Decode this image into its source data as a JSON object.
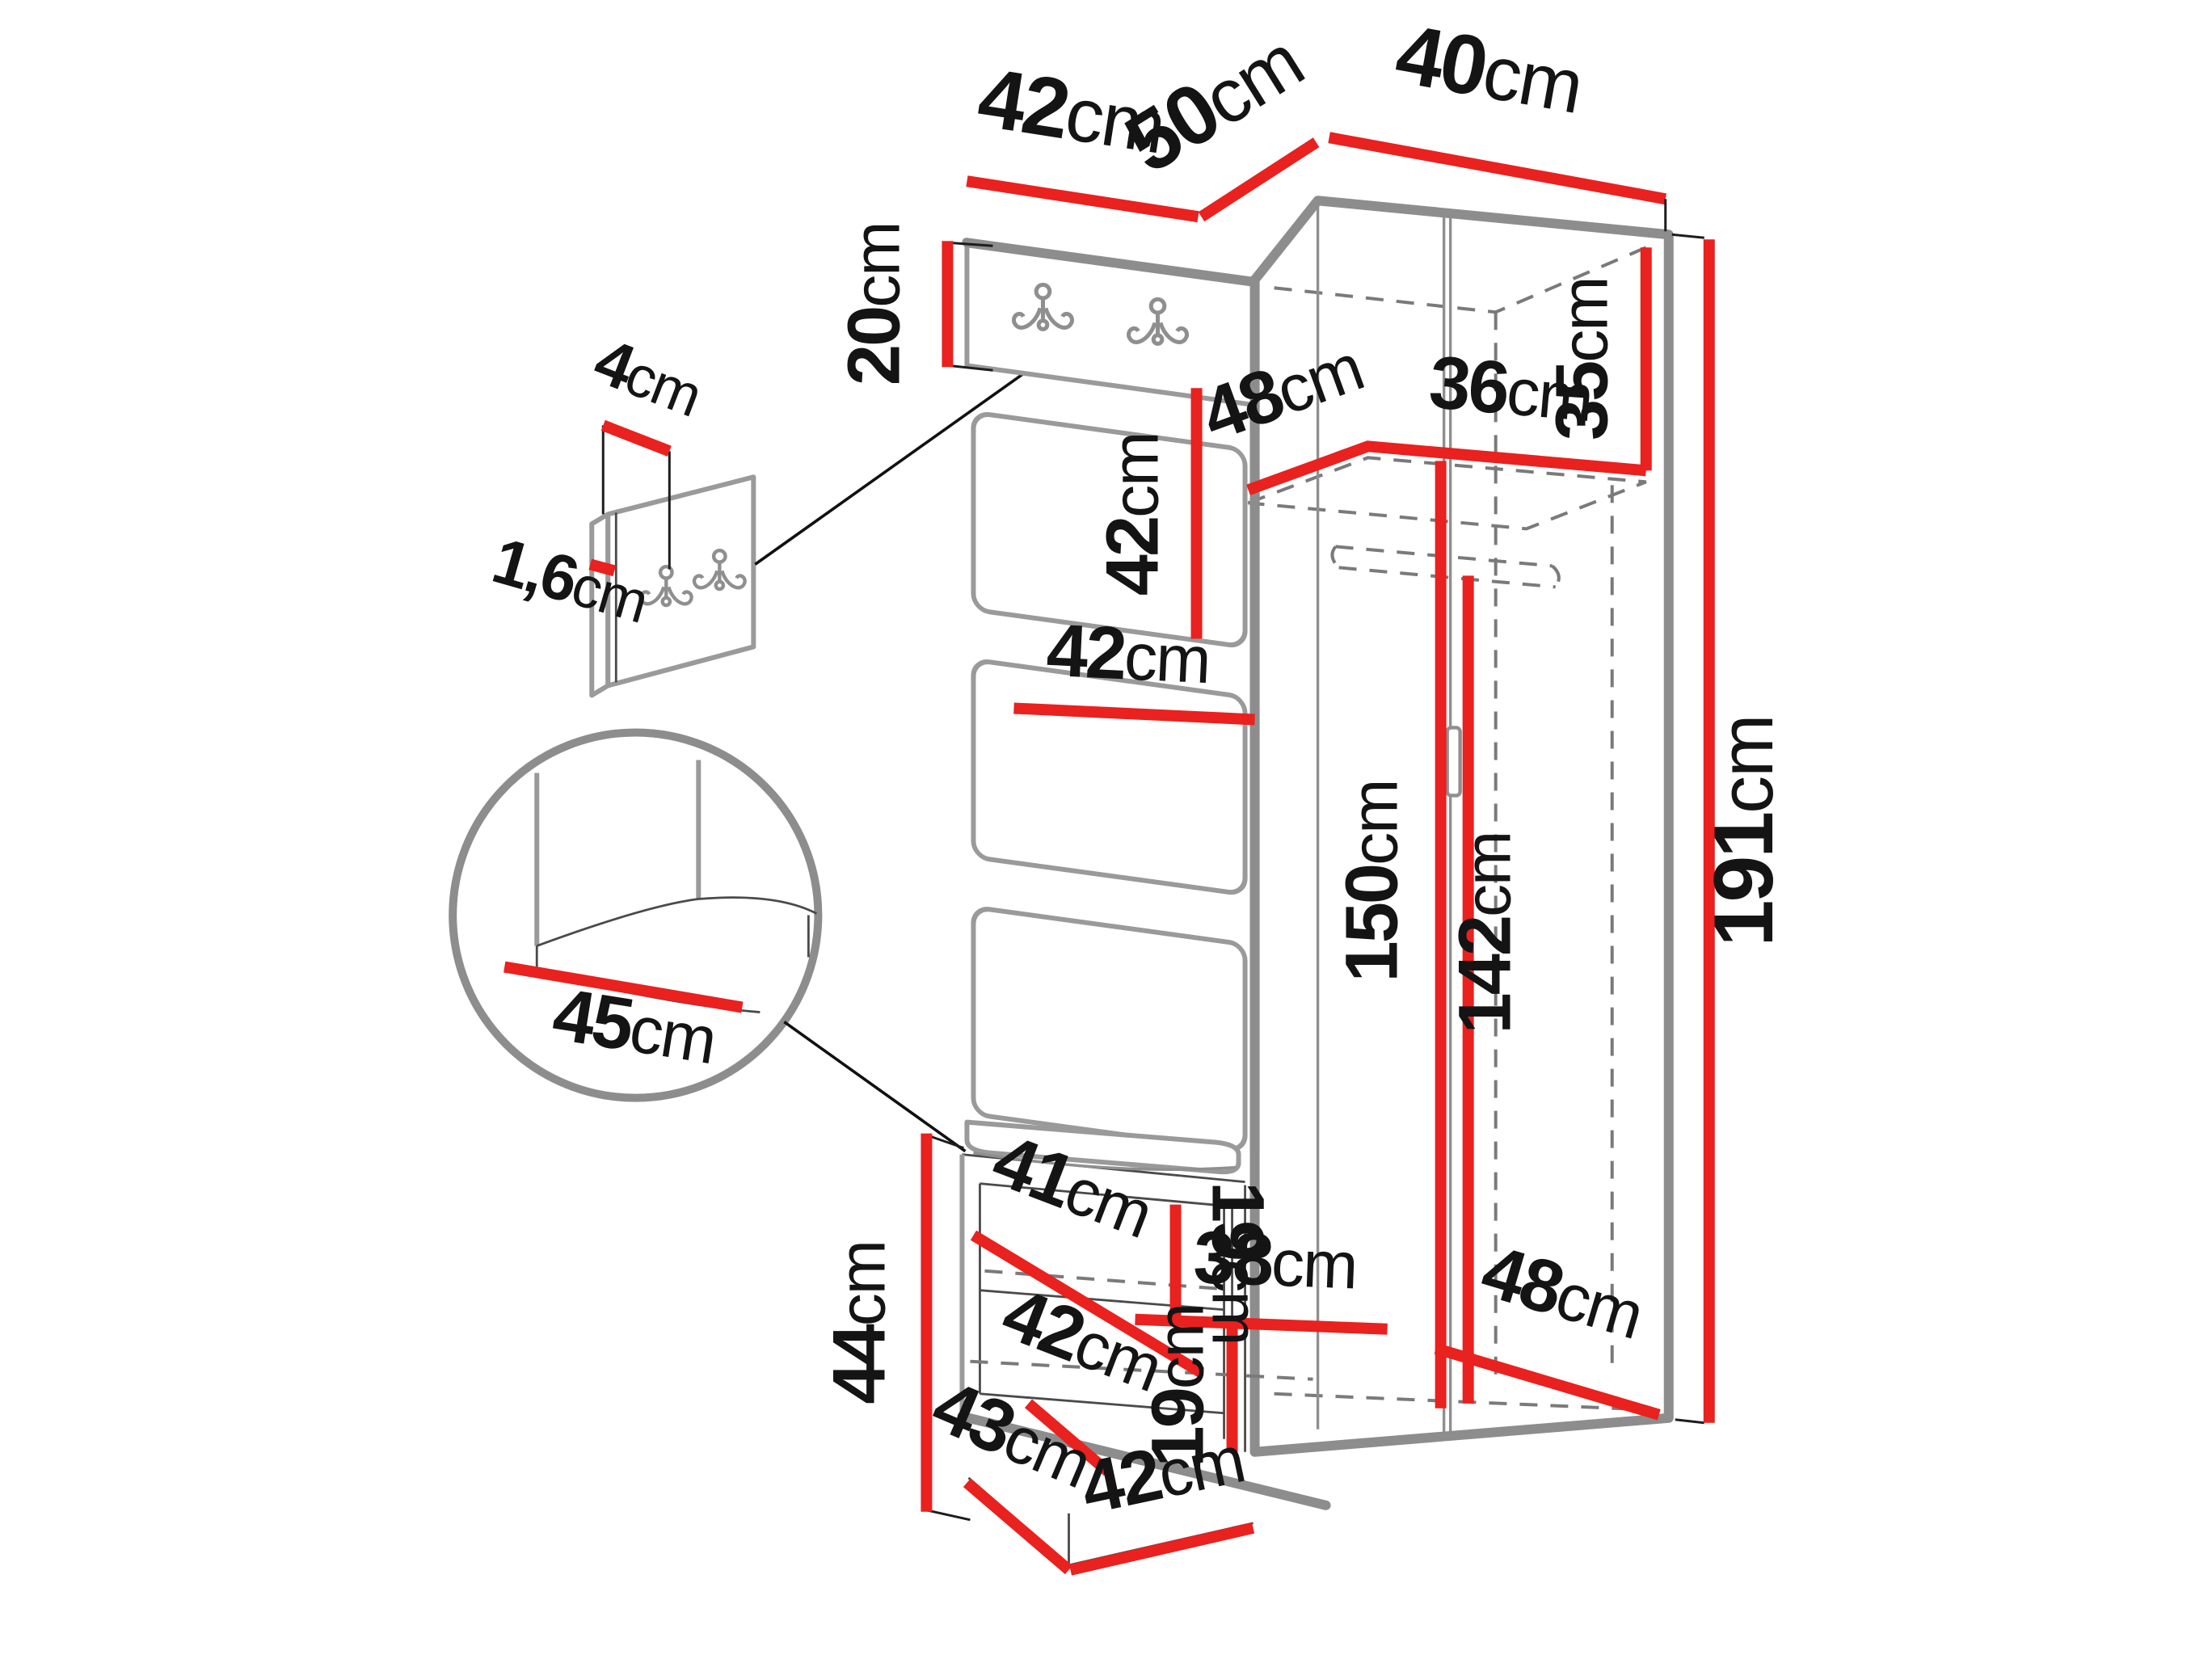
{
  "diagram": {
    "kind": "furniture-dimension-diagram",
    "background": "#ffffff"
  },
  "units": {
    "cm": "cm"
  },
  "colors": {
    "dimension_line": "#e9211f",
    "furniture_edge": "#8d8d8d",
    "hidden_line": "#7a7a7a",
    "text_ink": "#141414"
  },
  "icons": {
    "coat_hook": "double-coat-hook-icon",
    "door_handle": "vertical-bar-handle"
  },
  "dims": {
    "top_panel_width": "42",
    "top_corner_depth": "50",
    "top_side_width": "40",
    "hook_panel_height": "20",
    "detail_panel_width": "4",
    "detail_panel_thickness": "1,6",
    "cushion_panel_height": "42",
    "cushion_panel_width": "42",
    "interior_shelf_depth": "48",
    "interior_shelf_width": "36",
    "interior_top_height": "35",
    "door_height": "150",
    "rod_height": "142",
    "total_height": "191",
    "wardrobe_bottom_depth": "48",
    "bench_height": "44",
    "bench_shelf_depth": "41",
    "bench_shelf_gap_upper": "19",
    "bench_shelf_width": "38",
    "bench_floor_depth": "42",
    "bench_shelf_gap_lower": "19",
    "base_depth": "43",
    "base_width": "42",
    "seat_depth": "45"
  }
}
